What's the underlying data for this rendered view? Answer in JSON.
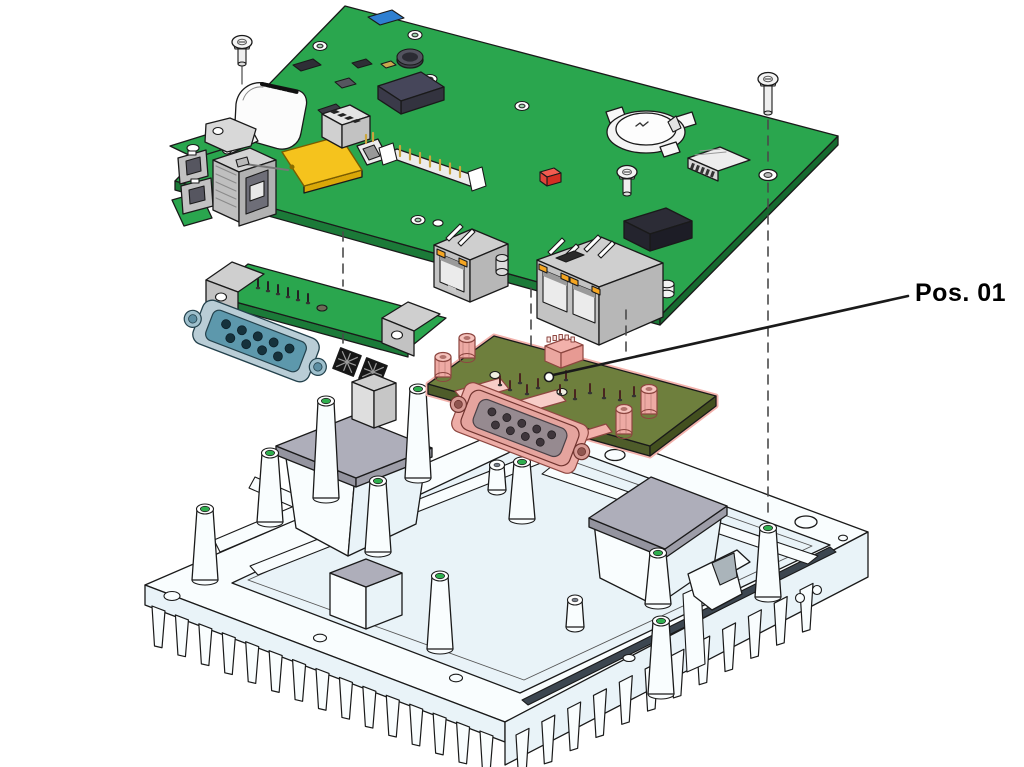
{
  "figure": {
    "type": "exploded-assembly-diagram",
    "background": "#ffffff"
  },
  "callout": {
    "label": "Pos. 01"
  },
  "colors": {
    "background": "#ffffff",
    "outline": "#1a1a1a",
    "pcb_green": "#2aa64e",
    "pcb_green_dark": "#1b7a38",
    "module_olive": "#6e7f3d",
    "module_olive_dark": "#4e5c2a",
    "highlight_pink": "#f2b1ab",
    "highlight_pink_light": "#f7cdc8",
    "highlight_pink_dark": "#8d4640",
    "chassis_white": "#f9fdfe",
    "chassis_tint": "#e9f3f8",
    "thermal_pad_gray": "#aeaeba",
    "metal_gray": "#cfcfcf",
    "dark_component": "#46465a",
    "black_component": "#2e2e36",
    "yellow_component": "#f5c31d",
    "red_component": "#e03a2f",
    "blue_component": "#2e7fd1",
    "led_orange": "#f5a623",
    "db9_teal": "#5d98ac",
    "db9_teal_dark": "#23414c",
    "hole_green": "#2fae4e",
    "guide_line": "#4a4a4a",
    "label_text": "#000000"
  }
}
